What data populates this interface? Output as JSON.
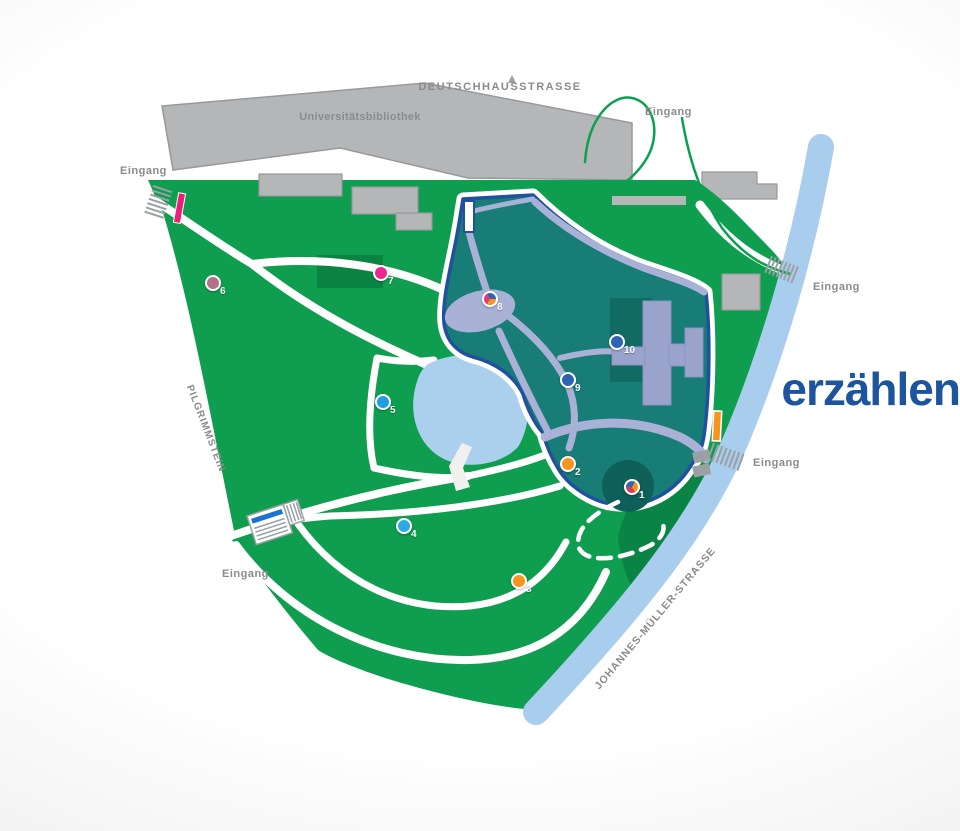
{
  "labels": {
    "street_top": "DEUTSCHHAUSSTRASSE",
    "library": "Universitätsbibliothek",
    "street_left": "PILGRIMMSTEIN",
    "street_right": "JOHANNES-MÜLLER-STRASSE",
    "entrance": "Eingang",
    "overlay_word": "erzählen"
  },
  "colors": {
    "park_green": "#0f9d4f",
    "dark_green": "#0a8444",
    "highlight_fill": "#177d76",
    "highlight_outline": "#20509e",
    "path_lavender": "#a9b2d6",
    "river_blue": "#a9cdec",
    "pond_blue": "#abd0ee",
    "building_gray": "#b5b6b8",
    "zone_building_gray": "#99a3cb",
    "label_gray": "#8a8b8d",
    "overlay_text_blue": "#1d549e",
    "entrance_bar_pink": "#ec1e79",
    "entrance_bar_orange": "#f7941d",
    "bus_stop_blue": "#1d71d1"
  },
  "markers": [
    {
      "number": "1",
      "x": 632,
      "y": 487,
      "type": "pie",
      "from": 150,
      "colors": [
        "#d63a5f",
        "#2e64b1",
        "#f7941d"
      ]
    },
    {
      "number": "2",
      "x": 568,
      "y": 464,
      "type": "dot",
      "color": "#f7941d"
    },
    {
      "number": "3",
      "x": 519,
      "y": 581,
      "type": "dot",
      "color": "#f7941d"
    },
    {
      "number": "4",
      "x": 404,
      "y": 526,
      "type": "dot",
      "color": "#29abe2"
    },
    {
      "number": "5",
      "x": 383,
      "y": 402,
      "type": "dot",
      "color": "#1e9de2"
    },
    {
      "number": "6",
      "x": 213,
      "y": 283,
      "type": "dot",
      "color": "#b17287"
    },
    {
      "number": "7",
      "x": 381,
      "y": 273,
      "type": "dot",
      "color": "#ec268f"
    },
    {
      "number": "8",
      "x": 490,
      "y": 299,
      "type": "pie",
      "from": 210,
      "colors": [
        "#e23a7a",
        "#2e64b1",
        "#f7941d"
      ]
    },
    {
      "number": "9",
      "x": 568,
      "y": 380,
      "type": "dot",
      "color": "#2e64b1"
    },
    {
      "number": "10",
      "x": 617,
      "y": 342,
      "type": "dot",
      "color": "#2e64b1"
    }
  ]
}
